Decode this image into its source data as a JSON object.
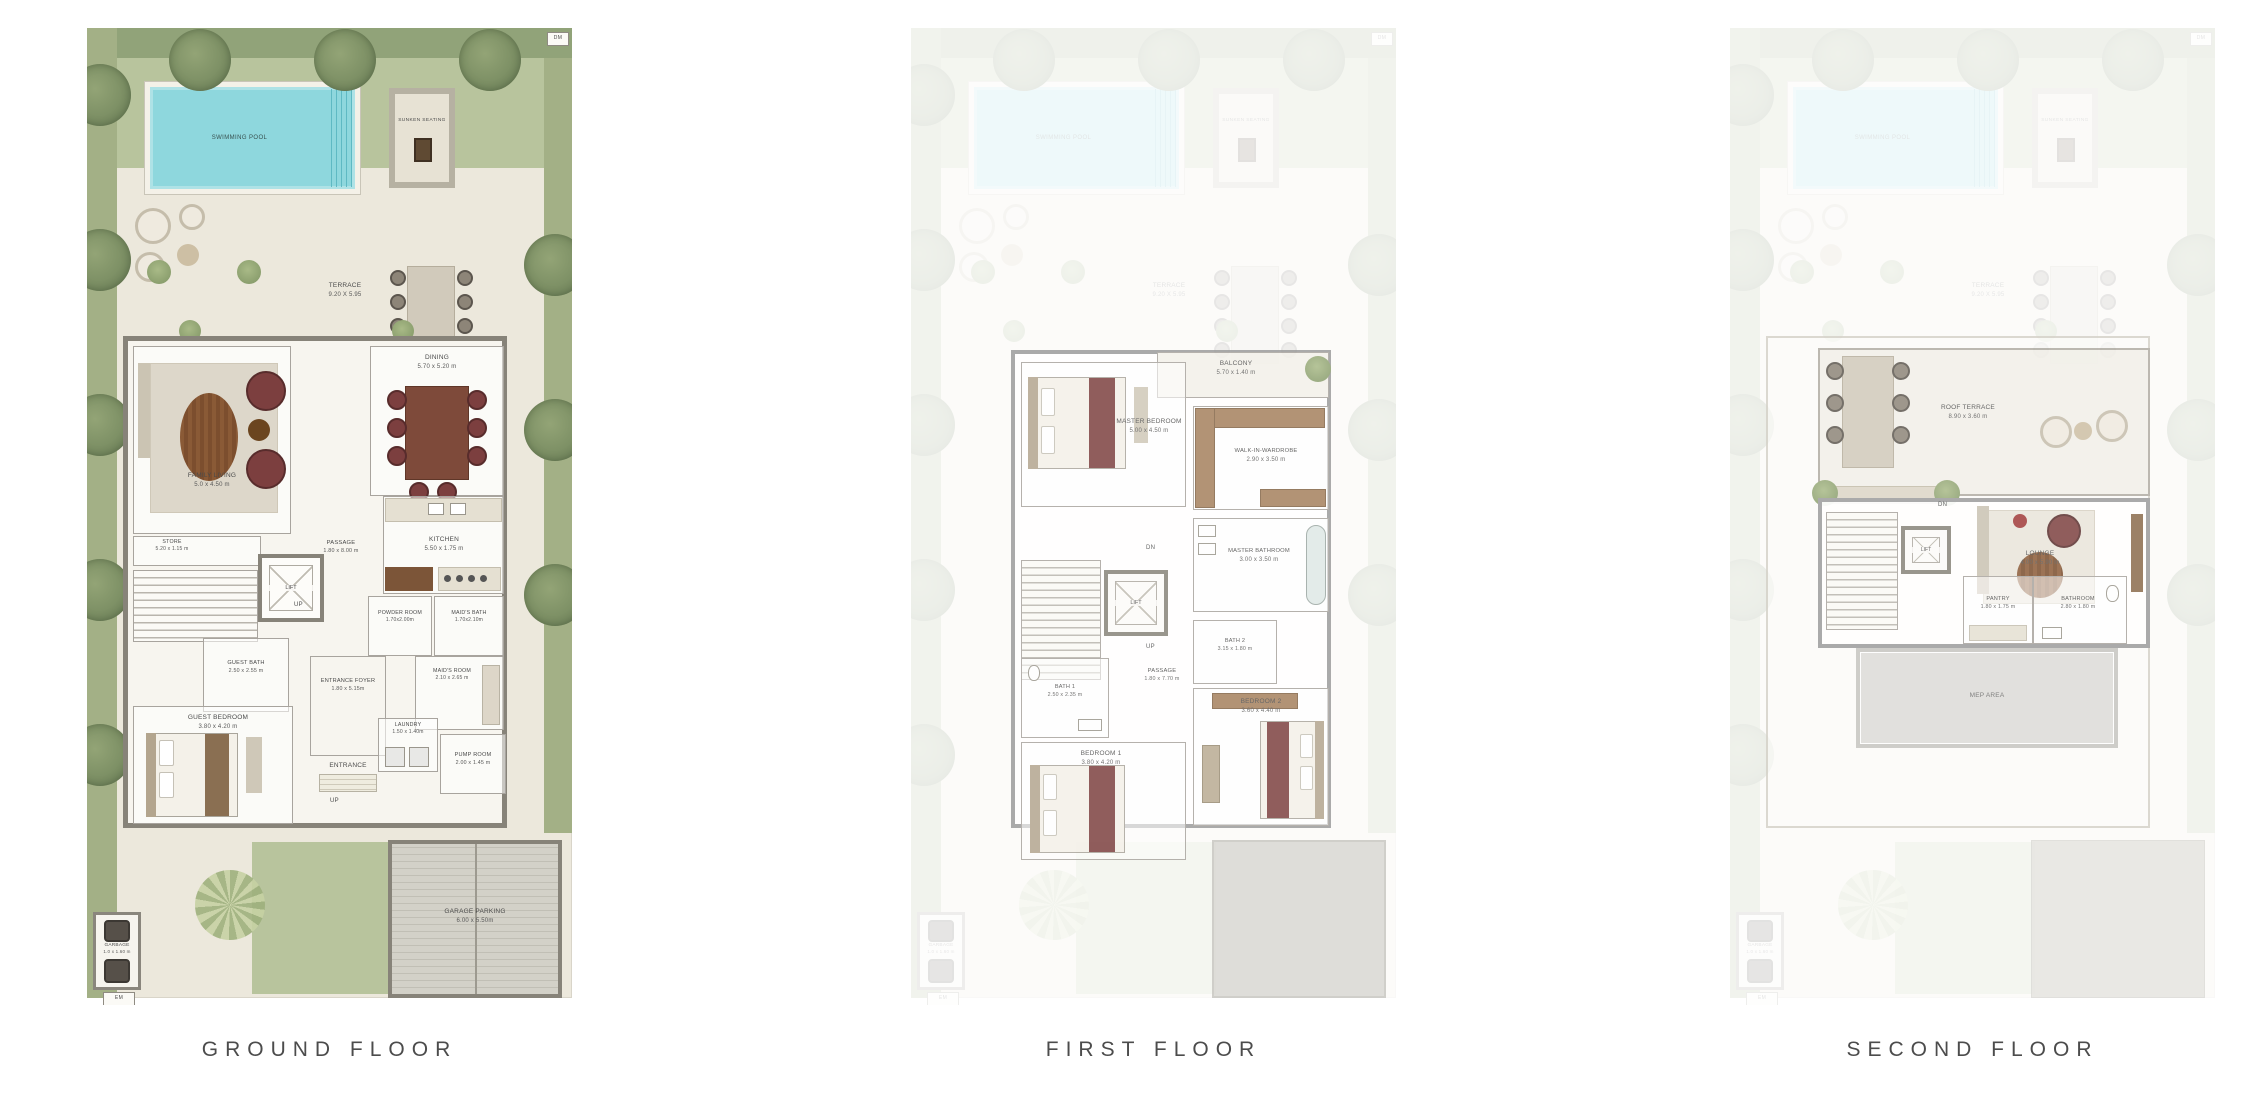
{
  "titles": {
    "ground": "GROUND FLOOR",
    "first": "FIRST FLOOR",
    "second": "SECOND FLOOR"
  },
  "colors": {
    "pool": "#8ed7dd",
    "lawn": "#b8c49d",
    "hedge": "#91a379",
    "garden_band": "#a3b086",
    "paving": "#ece8dc",
    "wall": "#878379",
    "furniture_maroon": "#7c3f3f",
    "wood": "#8a5a36",
    "title_text": "#4c4c4c",
    "garage_gray": "#d3d1c8"
  },
  "ground": {
    "site": {
      "pool": "SWIMMING POOL",
      "sunken_seating": "SUNKEN SEATING",
      "terrace_name": "TERRACE",
      "terrace_dims": "9.20 X 5.95",
      "dm": "DM",
      "em": "EM",
      "garbage_name": "GARBAGE",
      "garbage_dims": "1.0 x 1.60 m"
    },
    "rooms": {
      "family_living": {
        "name": "FAMILY LIVING",
        "dims": "5.0 x 4.50 m"
      },
      "dining": {
        "name": "DINING",
        "dims": "5.70 x 5.20 m"
      },
      "store": {
        "name": "STORE",
        "dims": "5.20 x 1.15 m"
      },
      "lift": {
        "name": "LIFT"
      },
      "passage": {
        "name": "PASSAGE",
        "dims": "1.80 x 8.00 m"
      },
      "kitchen": {
        "name": "KITCHEN",
        "dims": "5.50 x 1.75 m"
      },
      "powder_room": {
        "name": "POWDER ROOM",
        "dims": "1.70x2.00m"
      },
      "maids_bath": {
        "name": "MAID'S BATH",
        "dims": "1.70x2.10m"
      },
      "guest_bath": {
        "name": "GUEST BATH",
        "dims": "2.50 x 2.55 m"
      },
      "maids_room": {
        "name": "MAID'S ROOM",
        "dims": "2.10 x 2.65 m"
      },
      "entrance_foyer": {
        "name": "ENTRANCE FOYER",
        "dims": "1.80 x 5.15m"
      },
      "entrance": {
        "name": "ENTRANCE"
      },
      "guest_bedroom": {
        "name": "GUEST BEDROOM",
        "dims": "3.80 x 4.20 m"
      },
      "laundry": {
        "name": "LAUNDRY",
        "dims": "1.50 x 1.40m"
      },
      "pump_room": {
        "name": "PUMP ROOM",
        "dims": "2.00 x 1.45 m"
      },
      "garage": {
        "name": "GARAGE PARKING",
        "dims": "6.00 x 5.50m"
      }
    },
    "annotations": {
      "up_stairs": "UP",
      "up_drive": "UP"
    }
  },
  "first": {
    "rooms": {
      "master_bedroom": {
        "name": "MASTER BEDROOM",
        "dims": "5.00 x 4.50 m"
      },
      "balcony": {
        "name": "BALCONY",
        "dims": "5.70 x 1.40 m"
      },
      "walk_in_wardrobe": {
        "name": "WALK-IN-WARDROBE",
        "dims": "2.90 x 3.50 m"
      },
      "master_bathroom": {
        "name": "MASTER BATHROOM",
        "dims": "3.00 x 3.50 m"
      },
      "lift": {
        "name": "LIFT"
      },
      "passage": {
        "name": "PASSAGE",
        "dims": "1.80 x 7.70 m"
      },
      "bath_2": {
        "name": "BATH 2",
        "dims": "3.15 x 1.80 m"
      },
      "bath_1": {
        "name": "BATH 1",
        "dims": "2.50 x 2.35 m"
      },
      "bedroom_1": {
        "name": "BEDROOM 1",
        "dims": "3.80 x 4.20 m"
      },
      "bedroom_2": {
        "name": "BEDROOM 2",
        "dims": "3.60 x 4.40 m"
      }
    },
    "annotations": {
      "dn": "DN",
      "up": "UP"
    }
  },
  "second": {
    "rooms": {
      "roof_terrace": {
        "name": "ROOF TERRACE",
        "dims": "8.90 x 3.60 m"
      },
      "lift": {
        "name": "LIFT"
      },
      "lounge": {
        "name": "LOUNGE",
        "dims": "4.00 x 5.90 m"
      },
      "pantry": {
        "name": "PANTRY",
        "dims": "1.80 x 1.75 m"
      },
      "bathroom": {
        "name": "BATHROOM",
        "dims": "2.80 x 1.80 m"
      },
      "mep": {
        "name": "MEP AREA"
      }
    },
    "annotations": {
      "dn": "DN"
    }
  }
}
